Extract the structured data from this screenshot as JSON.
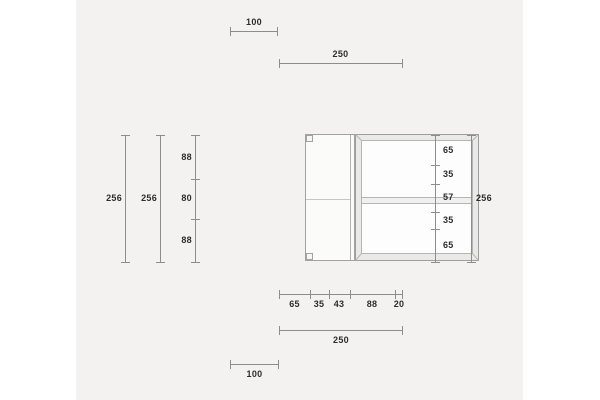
{
  "meta": {
    "description": "Technical dimension drawing of a cabinet: side panel and framed front panel with dimension lines"
  },
  "colors": {
    "page_background": "#ffffff",
    "canvas_background": "#f3f2f0",
    "dimension_line": "#8d8d8d",
    "label_text": "#2d2d2d",
    "panel_fill": "#fbfbfa",
    "frame_fill": "#e9e9e8",
    "outline": "#a2a2a2"
  },
  "dims": {
    "top_left": {
      "value": "100"
    },
    "top_right": {
      "value": "250"
    },
    "left_outer": {
      "value": "256"
    },
    "left_inner": {
      "value": "256"
    },
    "left_segments": {
      "values": [
        "88",
        "80",
        "88"
      ]
    },
    "right_segments": {
      "values": [
        "65",
        "35",
        "57",
        "35",
        "65"
      ]
    },
    "right_total": {
      "value": "256"
    },
    "bottom_segments": {
      "values": [
        "65",
        "35",
        "43",
        "88",
        "20"
      ]
    },
    "bottom_right": {
      "value": "250"
    },
    "bottom_left": {
      "value": "100"
    }
  }
}
